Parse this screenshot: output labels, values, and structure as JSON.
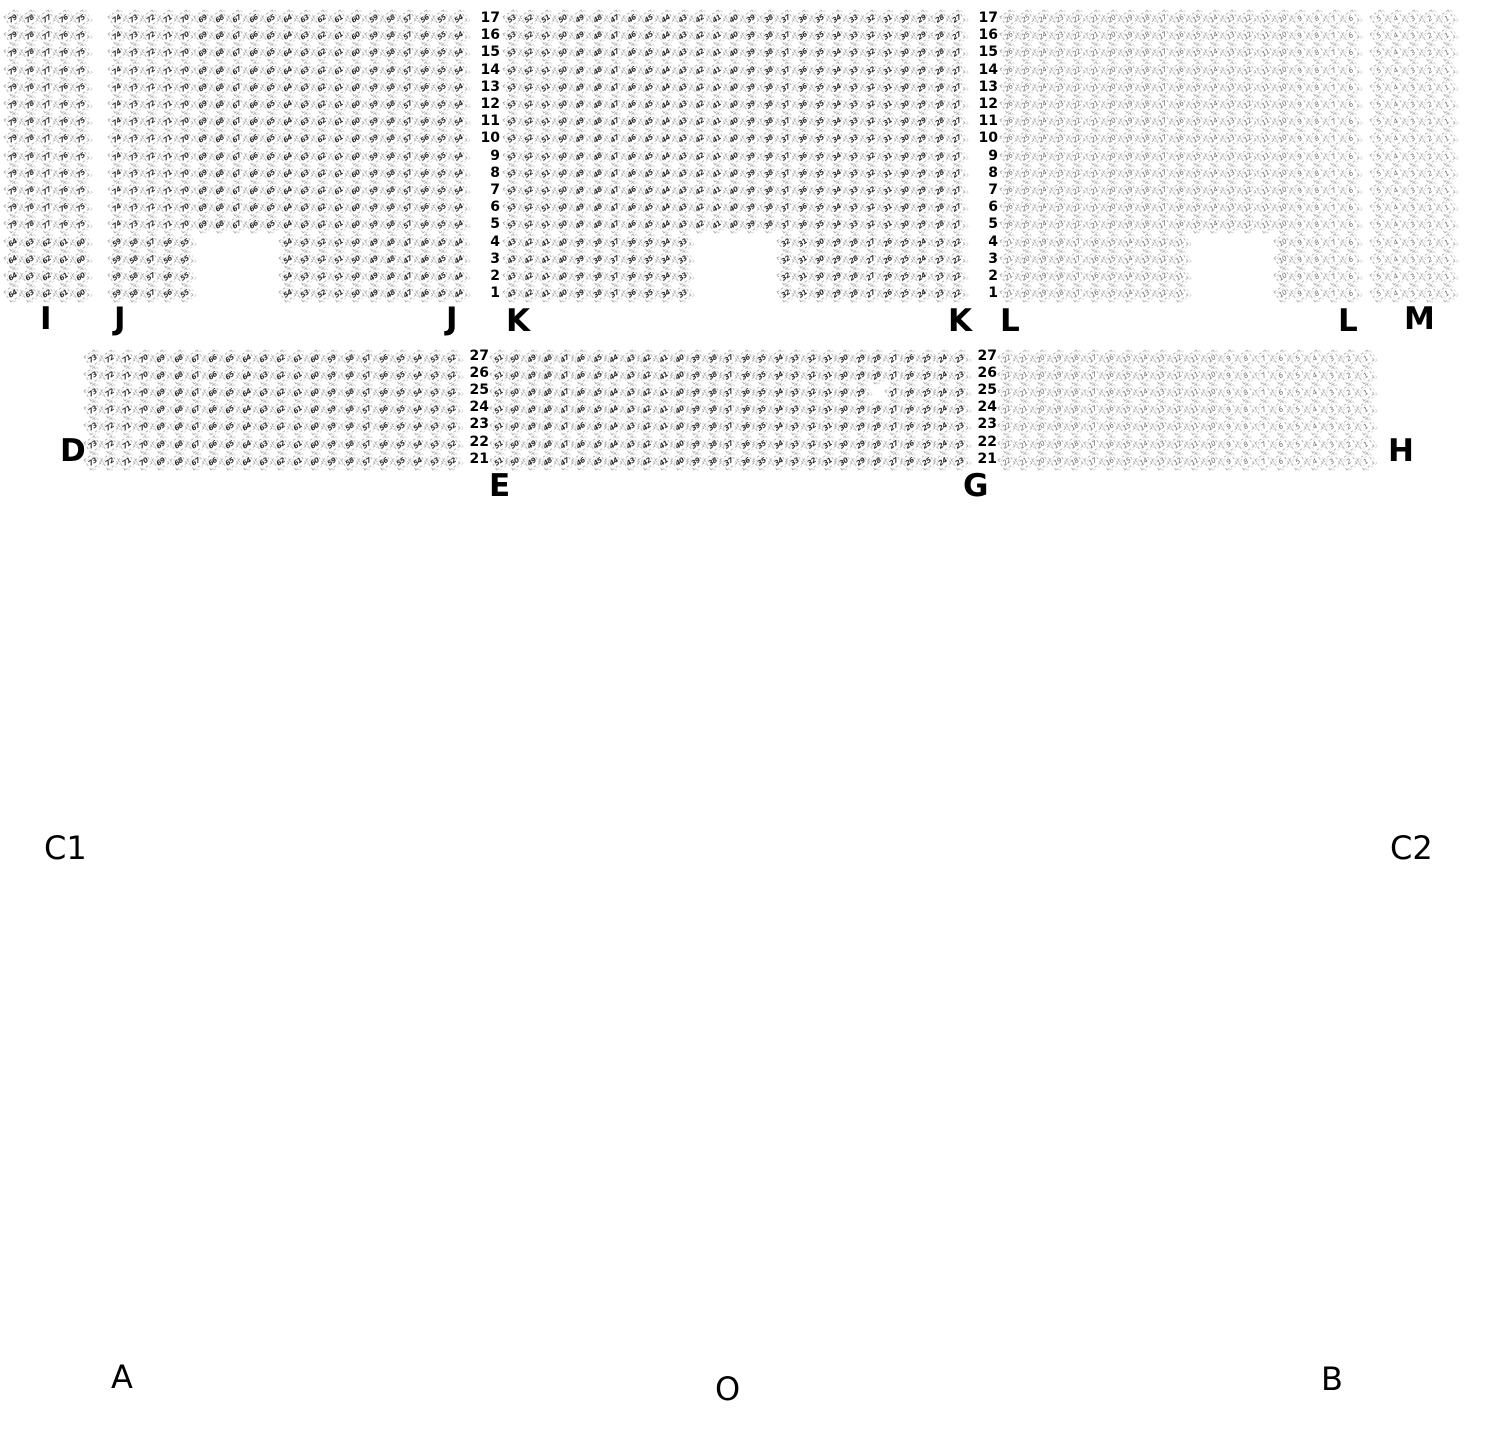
{
  "meta": {
    "type": "venue-seating-map",
    "background": "#ffffff",
    "seat_outline_color": "#b4b4b4",
    "seat_number_dark": "#2a2a2a",
    "seat_number_light": "#666666",
    "label_color": "#000000"
  },
  "row_label_columns": [
    {
      "x_right": 500,
      "y_top": 12,
      "pitch": 17.2,
      "labels": [
        "17",
        "16",
        "15",
        "14",
        "13",
        "12",
        "11",
        "10",
        "9",
        "8",
        "7",
        "6",
        "5",
        "4",
        "3",
        "2",
        "1"
      ]
    },
    {
      "x_right": 998,
      "y_top": 12,
      "pitch": 17.2,
      "labels": [
        "17",
        "16",
        "15",
        "14",
        "13",
        "12",
        "11",
        "10",
        "9",
        "8",
        "7",
        "6",
        "5",
        "4",
        "3",
        "2",
        "1"
      ]
    },
    {
      "x_right": 489,
      "y_top": 350,
      "pitch": 17.1,
      "labels": [
        "27",
        "26",
        "25",
        "24",
        "23",
        "22",
        "21"
      ]
    },
    {
      "x_right": 997,
      "y_top": 350,
      "pitch": 17.1,
      "labels": [
        "27",
        "26",
        "25",
        "24",
        "23",
        "22",
        "21"
      ]
    }
  ],
  "section_labels": [
    {
      "text": "I",
      "x": 40,
      "y": 303,
      "bold": true
    },
    {
      "text": "J",
      "x": 114,
      "y": 303,
      "bold": true
    },
    {
      "text": "J",
      "x": 446,
      "y": 303,
      "bold": true
    },
    {
      "text": "K",
      "x": 506,
      "y": 305,
      "bold": true
    },
    {
      "text": "K",
      "x": 948,
      "y": 305,
      "bold": true
    },
    {
      "text": "L",
      "x": 1000,
      "y": 305,
      "bold": true
    },
    {
      "text": "L",
      "x": 1338,
      "y": 305,
      "bold": true
    },
    {
      "text": "M",
      "x": 1404,
      "y": 303,
      "bold": true
    },
    {
      "text": "D",
      "x": 60,
      "y": 435,
      "bold": true
    },
    {
      "text": "E",
      "x": 489,
      "y": 470,
      "bold": true
    },
    {
      "text": "G",
      "x": 963,
      "y": 470,
      "bold": true
    },
    {
      "text": "H",
      "x": 1388,
      "y": 435,
      "bold": true
    },
    {
      "text": "C1",
      "x": 44,
      "y": 832,
      "bold": false
    },
    {
      "text": "C2",
      "x": 1390,
      "y": 832,
      "bold": false
    },
    {
      "text": "A",
      "x": 111,
      "y": 1361,
      "bold": false
    },
    {
      "text": "O",
      "x": 715,
      "y": 1373,
      "bold": false
    },
    {
      "text": "B",
      "x": 1321,
      "y": 1363,
      "bold": false
    }
  ],
  "seat_blocks": [
    {
      "name": "I",
      "x": 6,
      "y": 12,
      "top_row": 17,
      "col_pitch": 17.1,
      "row_pitch": 17.2,
      "light": false,
      "row_groups": [
        {
          "row_from": 17,
          "row_to": 5,
          "segments": [
            {
              "col": 0,
              "count": 5,
              "start": 79
            }
          ]
        },
        {
          "row_from": 4,
          "row_to": 1,
          "segments": [
            {
              "col": 0,
              "count": 5,
              "start": 64
            }
          ]
        }
      ]
    },
    {
      "name": "J",
      "x": 110,
      "y": 12,
      "top_row": 17,
      "col_pitch": 17.1,
      "row_pitch": 17.2,
      "light": false,
      "row_groups": [
        {
          "row_from": 17,
          "row_to": 5,
          "segments": [
            {
              "col": 0,
              "count": 21,
              "start": 74
            }
          ]
        },
        {
          "row_from": 4,
          "row_to": 1,
          "segments": [
            {
              "col": 0,
              "count": 5,
              "start": 59
            },
            {
              "col": 10,
              "count": 11,
              "start": 54
            }
          ]
        }
      ]
    },
    {
      "name": "K",
      "x": 505,
      "y": 12,
      "top_row": 17,
      "col_pitch": 17.1,
      "row_pitch": 17.2,
      "light": false,
      "row_groups": [
        {
          "row_from": 17,
          "row_to": 5,
          "segments": [
            {
              "col": 0,
              "count": 27,
              "start": 53
            }
          ]
        },
        {
          "row_from": 4,
          "row_to": 1,
          "segments": [
            {
              "col": 0,
              "count": 11,
              "start": 43
            },
            {
              "col": 16,
              "count": 11,
              "start": 32
            }
          ]
        }
      ]
    },
    {
      "name": "L",
      "x": 1002,
      "y": 12,
      "top_row": 17,
      "col_pitch": 17.1,
      "row_pitch": 17.2,
      "light": true,
      "row_groups": [
        {
          "row_from": 17,
          "row_to": 5,
          "segments": [
            {
              "col": 0,
              "count": 21,
              "start": 26
            }
          ]
        },
        {
          "row_from": 4,
          "row_to": 1,
          "segments": [
            {
              "col": 0,
              "count": 11,
              "start": 21
            },
            {
              "col": 16,
              "count": 5,
              "start": 10
            }
          ]
        }
      ]
    },
    {
      "name": "M",
      "x": 1372,
      "y": 12,
      "top_row": 17,
      "col_pitch": 17.1,
      "row_pitch": 17.2,
      "light": true,
      "row_groups": [
        {
          "row_from": 17,
          "row_to": 1,
          "segments": [
            {
              "col": 0,
              "count": 5,
              "start": 5
            }
          ]
        }
      ]
    },
    {
      "name": "D",
      "x": 86,
      "y": 352,
      "top_row": 27,
      "col_pitch": 17.1,
      "row_pitch": 17.1,
      "light": false,
      "row_groups": [
        {
          "row_from": 27,
          "row_to": 21,
          "segments": [
            {
              "col": 0,
              "count": 22,
              "start": 73
            }
          ]
        }
      ]
    },
    {
      "name": "EG",
      "x": 492,
      "y": 352,
      "top_row": 27,
      "col_pitch": 16.45,
      "row_pitch": 17.1,
      "light": false,
      "missing": [
        {
          "row": 25,
          "col": 23
        }
      ],
      "row_groups": [
        {
          "row_from": 27,
          "row_to": 21,
          "segments": [
            {
              "col": 0,
              "count": 29,
              "start": 51
            }
          ]
        }
      ]
    },
    {
      "name": "H",
      "x": 1000,
      "y": 352,
      "top_row": 27,
      "col_pitch": 17.1,
      "row_pitch": 17.1,
      "light": true,
      "row_groups": [
        {
          "row_from": 27,
          "row_to": 21,
          "segments": [
            {
              "col": 0,
              "count": 22,
              "start": 22
            }
          ]
        }
      ]
    }
  ]
}
